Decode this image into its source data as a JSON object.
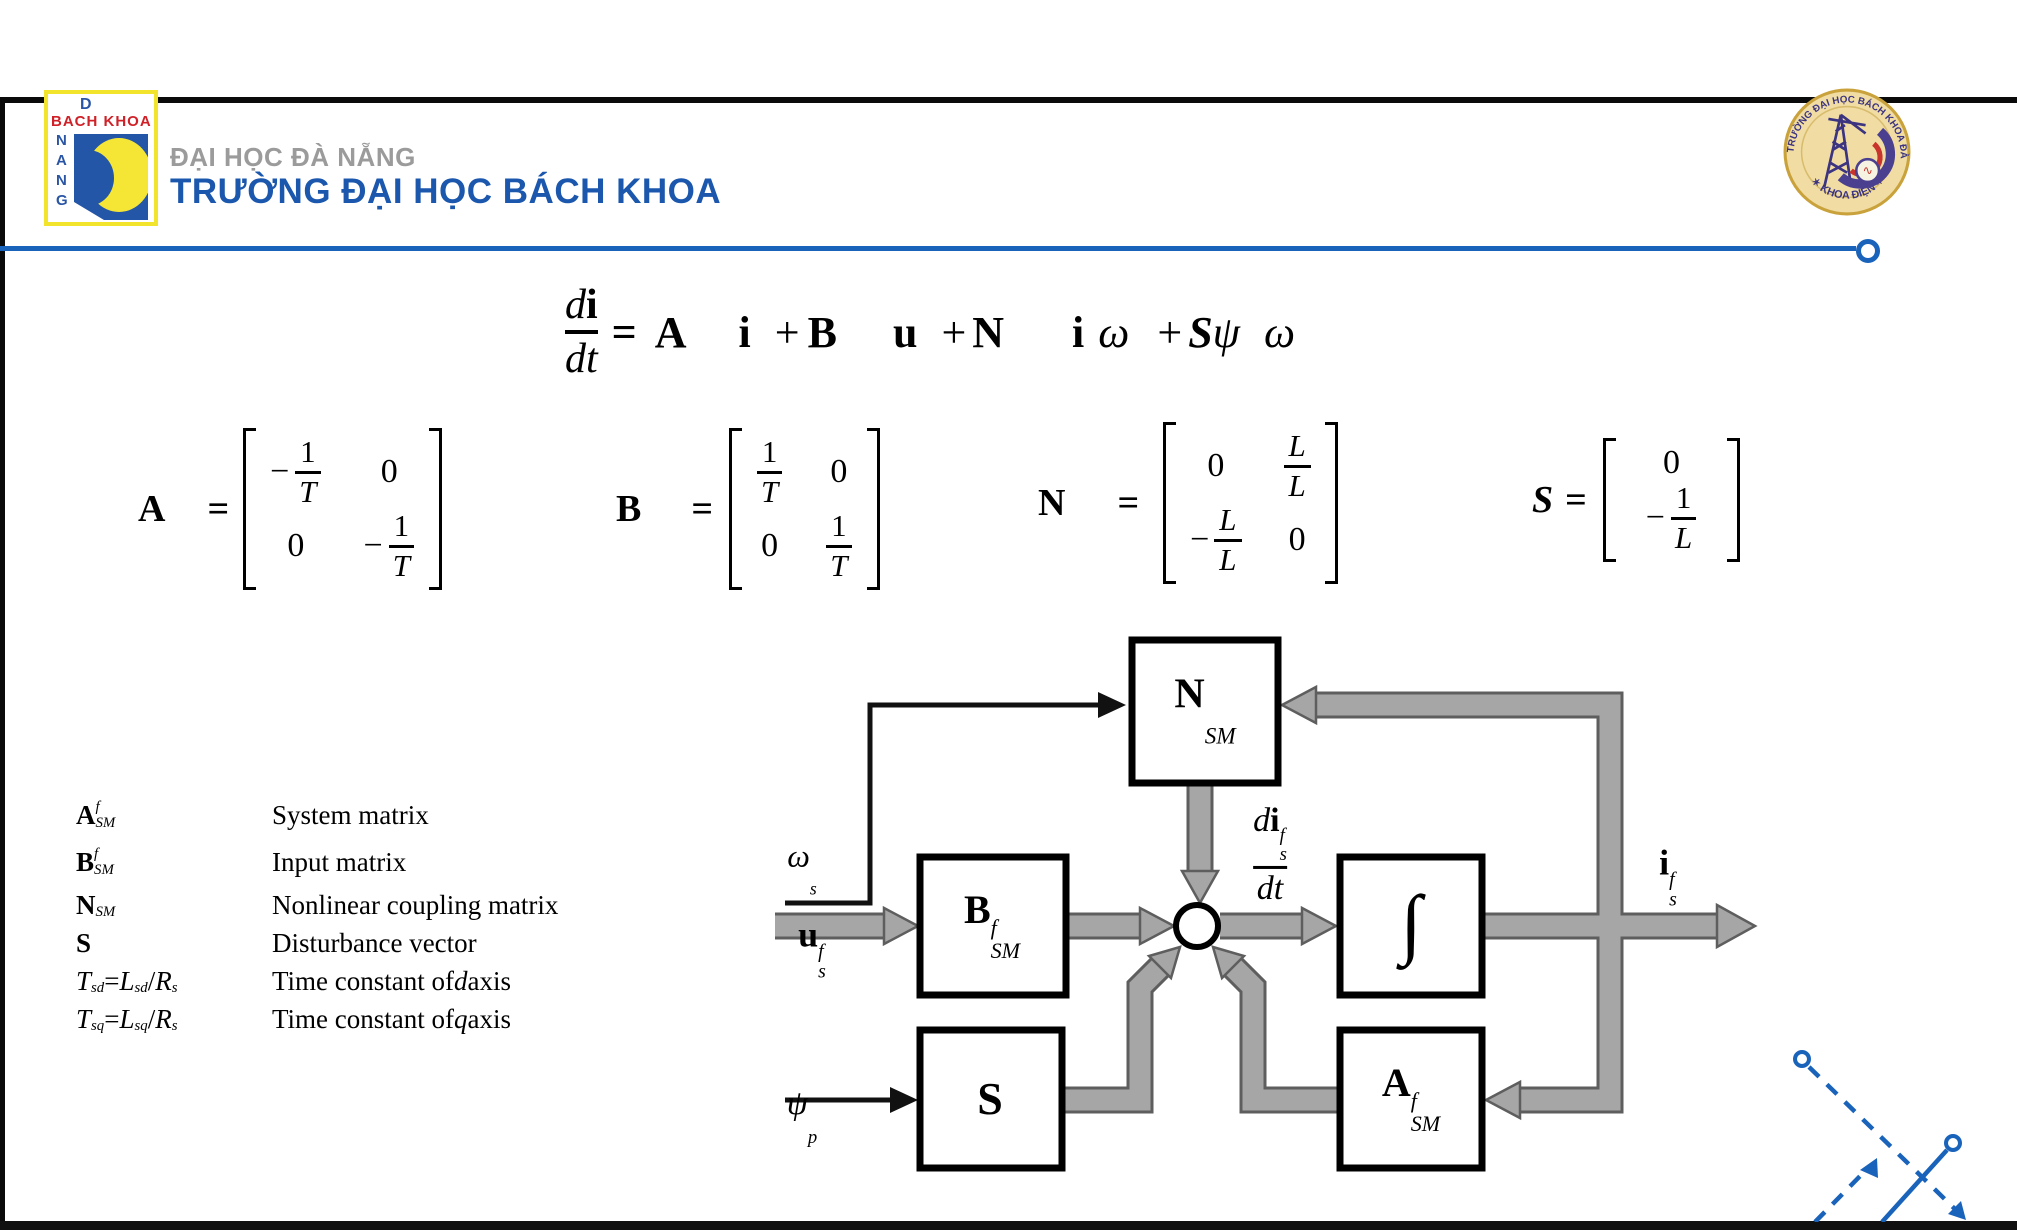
{
  "colors": {
    "accent_blue": "#1a63bb",
    "school_blue": "#1a57ad",
    "gray_text": "#9b9b9b",
    "arrow_gray": "#a6a6a6",
    "arrow_outline": "#5e5e5e",
    "logo_yellow": "#f5e636",
    "logo_red": "#cf2127",
    "logo_blue": "#2456a8",
    "seal_gold": "#c9a23c",
    "seal_navy": "#3c3480"
  },
  "header": {
    "logo_left": {
      "d": "D",
      "bach_khoa": "BACH KHOA",
      "vertical": "NANG"
    },
    "university": "ĐẠI HỌC ĐÀ NẴNG",
    "school": "TRƯỜNG ĐẠI HỌC BÁCH KHOA",
    "seal": {
      "text_top": "TRƯỜNG ĐẠI HỌC BÁCH KHOA ĐÀ NẴNG",
      "text_bottom": "✶ KHOA ĐIỆN ✶",
      "wave": "∿"
    }
  },
  "equation": {
    "num": [
      {
        "t": "d",
        "s": "i"
      },
      {
        "t": "i",
        "s": "b"
      }
    ],
    "den": [
      {
        "t": "d",
        "s": "i"
      },
      {
        "t": "t",
        "s": "i"
      }
    ],
    "rhs": [
      {
        "t": "=",
        "s": "b"
      },
      {
        "sp": 18
      },
      {
        "t": "A",
        "s": "b"
      },
      {
        "sp": 52
      },
      {
        "t": "i",
        "s": "b"
      },
      {
        "sp": 24
      },
      {
        "t": "+",
        "s": ""
      },
      {
        "sp": 8
      },
      {
        "t": "B",
        "s": "b"
      },
      {
        "sp": 56
      },
      {
        "t": "u",
        "s": "b"
      },
      {
        "sp": 24
      },
      {
        "t": "+",
        "s": ""
      },
      {
        "sp": 6
      },
      {
        "t": "N",
        "s": "b"
      },
      {
        "sp": 68
      },
      {
        "t": "i",
        "s": "b"
      },
      {
        "sp": 14
      },
      {
        "t": "ω",
        "s": "i"
      },
      {
        "sp": 28
      },
      {
        "t": "+",
        "s": ""
      },
      {
        "sp": 6
      },
      {
        "t": "S",
        "s": "bi"
      },
      {
        "t": "ψ",
        "s": "i"
      },
      {
        "sp": 24
      },
      {
        "t": "ω",
        "s": "i"
      }
    ]
  },
  "matrices": [
    {
      "label": [
        {
          "t": "A",
          "s": "b"
        }
      ],
      "eq": "=",
      "cols": 2,
      "cells": [
        "-1/T",
        "0",
        "0",
        "-1/T"
      ]
    },
    {
      "label": [
        {
          "t": "B",
          "s": "b"
        }
      ],
      "eq": "=",
      "cols": 2,
      "cells": [
        "1/T",
        "0",
        "0",
        "1/T"
      ]
    },
    {
      "label": [
        {
          "t": "N",
          "s": "b"
        }
      ],
      "eq": "=",
      "cols": 2,
      "cells": [
        "0",
        "L/L",
        "-L/L",
        "0"
      ]
    },
    {
      "label": [
        {
          "t": "S",
          "s": "bi"
        }
      ],
      "eq": "=",
      "cols": 1,
      "cells": [
        "0",
        "-1/L"
      ]
    }
  ],
  "legend": [
    {
      "tall": true,
      "symbol": [
        {
          "t": "A",
          "s": "b"
        },
        {
          "sup": "f",
          "sub": "SM"
        }
      ],
      "desc": [
        {
          "t": "System matrix",
          "s": ""
        }
      ]
    },
    {
      "tall": true,
      "symbol": [
        {
          "t": "B",
          "s": "b"
        },
        {
          "sup": "f",
          "sub": "SM"
        }
      ],
      "desc": [
        {
          "t": "Input matrix",
          "s": ""
        }
      ]
    },
    {
      "tall": false,
      "symbol": [
        {
          "t": "N",
          "s": "b"
        },
        {
          "sub": "SM"
        }
      ],
      "desc": [
        {
          "t": "Nonlinear coupling matrix",
          "s": ""
        }
      ]
    },
    {
      "tall": false,
      "symbol": [
        {
          "t": "S",
          "s": "b"
        }
      ],
      "desc": [
        {
          "t": "Disturbance vector",
          "s": ""
        }
      ]
    },
    {
      "tall": false,
      "symbol": [
        {
          "t": "T",
          "s": "i"
        },
        {
          "sub": "sd"
        },
        {
          "t": " = ",
          "s": ""
        },
        {
          "t": "L",
          "s": "i"
        },
        {
          "sub": "sd"
        },
        {
          "t": "/",
          "s": ""
        },
        {
          "t": "R",
          "s": "i"
        },
        {
          "sub": "s"
        }
      ],
      "desc": [
        {
          "t": "Time constant of ",
          "s": ""
        },
        {
          "t": "d",
          "s": "i"
        },
        {
          "t": " axis",
          "s": ""
        }
      ]
    },
    {
      "tall": false,
      "symbol": [
        {
          "t": "T",
          "s": "i"
        },
        {
          "sub": "sq"
        },
        {
          "t": " = ",
          "s": ""
        },
        {
          "t": "L",
          "s": "i"
        },
        {
          "sub": "sq"
        },
        {
          "t": "/",
          "s": ""
        },
        {
          "t": "R",
          "s": "i"
        },
        {
          "sub": "s"
        }
      ],
      "desc": [
        {
          "t": "Time constant of ",
          "s": ""
        },
        {
          "t": "q",
          "s": "i"
        },
        {
          "t": " axis",
          "s": ""
        }
      ]
    }
  ],
  "diagram": {
    "blocks": {
      "nsm": [
        {
          "t": "N",
          "s": "b"
        },
        {
          "sub": "SM"
        }
      ],
      "bsm": [
        {
          "t": "B",
          "s": "b"
        },
        {
          "sup": "f",
          "sub": "SM"
        }
      ],
      "integrator": [
        {
          "t": "∫",
          "s": ""
        }
      ],
      "asm": [
        {
          "t": "A",
          "s": "b"
        },
        {
          "sup": "f",
          "sub": "SM"
        }
      ],
      "s_block": [
        {
          "t": "S",
          "s": "b"
        }
      ]
    },
    "labels": {
      "omega_s": [
        {
          "t": "ω",
          "s": "i"
        },
        {
          "sub": "s"
        }
      ],
      "u_s_f": [
        {
          "t": "u",
          "s": "b"
        },
        {
          "sup": "f",
          "sub": "s"
        }
      ],
      "psi_p": [
        {
          "t": "ψ",
          "s": "i"
        },
        {
          "sub": "p"
        }
      ],
      "i_s_f": [
        {
          "t": "i",
          "s": "b"
        },
        {
          "sup": "f",
          "sub": "s"
        }
      ],
      "didt_num": [
        {
          "t": "d",
          "s": "i"
        },
        {
          "t": "i",
          "s": "b"
        },
        {
          "sup": "f",
          "sub": "s"
        }
      ],
      "didt_den": [
        {
          "t": "d",
          "s": "i"
        },
        {
          "t": "t",
          "s": "i"
        }
      ]
    }
  }
}
